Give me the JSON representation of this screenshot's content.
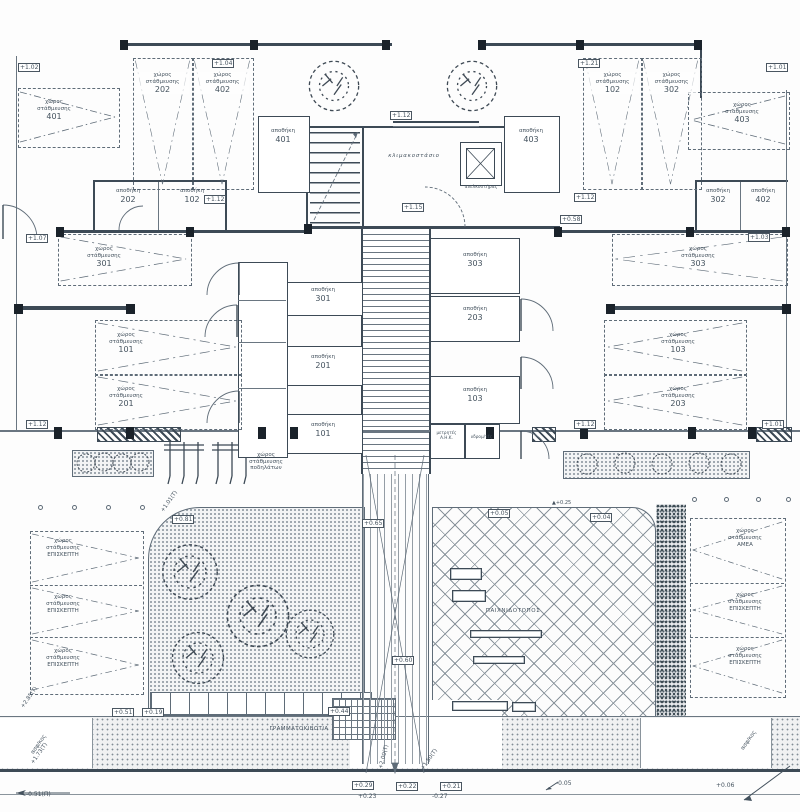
{
  "labels": {
    "storage_word": "αποθήκη",
    "parking_l1": "χώρος",
    "parking_l2": "στάθμευσης",
    "visitor": "ΕΠΙΣΚΕΠΤΗ",
    "amea": "ΑΜΕΑ",
    "bike_l1": "χώρος",
    "bike_l2": "στάθμευσης",
    "bike_l3": "ποδηλάτων",
    "mailboxes": "ΓΡΑΜΜΑΤΟΚΙΒΩΤΙΑ",
    "playground": "ΠΑΙΧΝΙΔΟΤΟΠΟΣ",
    "stair": "κλιμακοστάσιο",
    "elevator": "ανελκυστήρας",
    "meters_1": "μετρητές",
    "meters_2": "Α.Η.Κ.",
    "water_meters": "υδρομ/τές",
    "asphalt": "ασφ/κος"
  },
  "storage_rooms": {
    "s401": "401",
    "s403": "403",
    "s202": "202",
    "s102": "102",
    "s302": "302",
    "s402": "402",
    "s301": "301",
    "s201": "201",
    "s101": "101",
    "s303": "303",
    "s203": "203",
    "s103": "103"
  },
  "parking_stalls": {
    "p401": "401",
    "p202": "202",
    "p402": "402",
    "p102": "102",
    "p302": "302",
    "p403": "403",
    "p301": "301",
    "p101": "101",
    "p201": "201",
    "p103": "103",
    "p203": "203",
    "p303": "303"
  },
  "elevations": {
    "top112": "+1.12",
    "hall115": "+1.15",
    "l112": "+1.12",
    "r112": "+1.12",
    "v058": "+0.58",
    "l107": "+1.07",
    "r103": "+1.03",
    "tr101": "+1.01",
    "tl102": "+1.02",
    "tl104": "+1.04",
    "tr121": "+1.21",
    "ml112": "+1.12",
    "mr112": "+1.12",
    "mr101": "+1.01",
    "g081": "+0.81",
    "v065": "+0.65",
    "p005": "+0.05",
    "p004": "+0.04",
    "tri025": "+0.25",
    "v044": "+0.44",
    "v051": "+0.51",
    "v019": "+0.19",
    "v060": "+0.60",
    "s029": "+0.29",
    "s023": "+0.23",
    "s022": "+0.22",
    "s021": "+0.21",
    "sm027": "-0.27",
    "sm005": "-0.05",
    "s006": "+0.06",
    "corner051": "-0.51(Π)",
    "r285": "+2.85(Τ)",
    "r173": "+1.73(Τ)",
    "r101": "+1.01(Τ)",
    "r200": "+2.00(Τ)",
    "r150": "+1.50(Τ)"
  },
  "icons": {
    "level_triangle": "▲"
  }
}
